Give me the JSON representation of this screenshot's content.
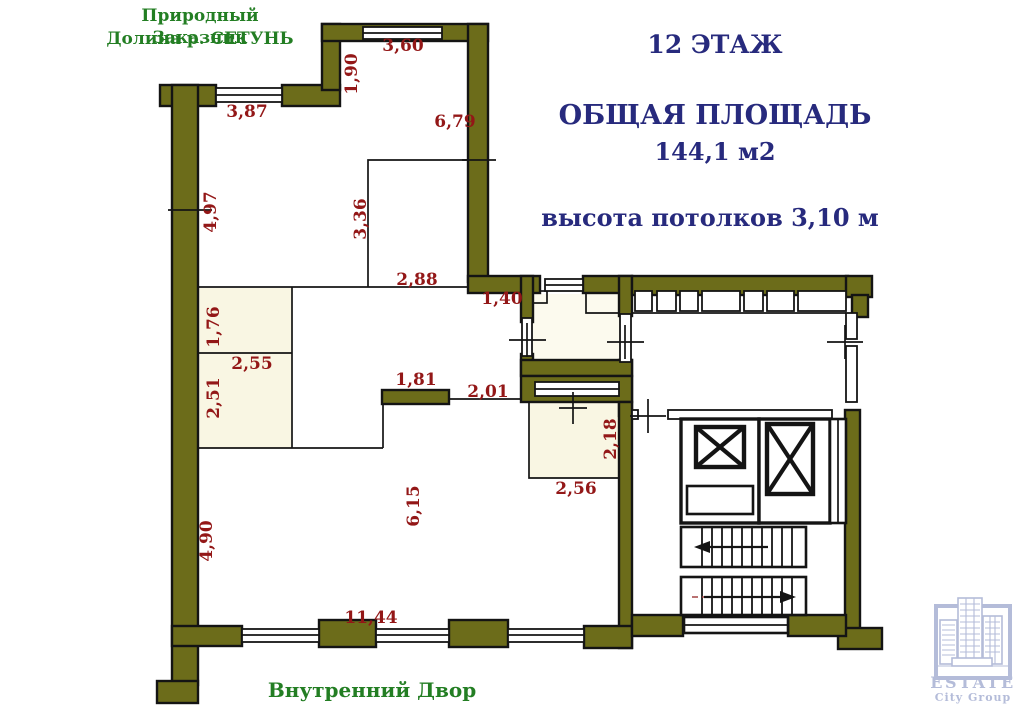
{
  "page": {
    "width": 1023,
    "height": 710,
    "background": "#ffffff"
  },
  "colors": {
    "wall": "#6c6c1a",
    "outline": "#141414",
    "cream": "#f9f6e3",
    "cream2": "#fcfaee",
    "red": "#931717",
    "green": "#237e23",
    "navy": "#272a7d",
    "logo": "#a8b1d3"
  },
  "header": {
    "nature_reserve_line1": "Природный Заказник",
    "nature_reserve_line2": "Долина р. СЕТУНЬ",
    "floor_title": "12 ЭТАЖ",
    "area_title": "ОБЩАЯ ПЛОЩАДЬ",
    "area_value": "144,1 м2",
    "ceiling_height": "высота потолков 3,10 м"
  },
  "footer": {
    "courtyard": "Внутренний Двор"
  },
  "logo": {
    "line1": "ESTATE",
    "line2": "City Group"
  },
  "dimensions": [
    {
      "text": "3,60",
      "x": 403,
      "y": 46
    },
    {
      "text": "1,90",
      "x": 352,
      "y": 74,
      "rot": true
    },
    {
      "text": "3,87",
      "x": 247,
      "y": 112
    },
    {
      "text": "6,79",
      "x": 455,
      "y": 122
    },
    {
      "text": "4,97",
      "x": 211,
      "y": 212,
      "rot": true
    },
    {
      "text": "3,36",
      "x": 361,
      "y": 219,
      "rot": true
    },
    {
      "text": "2,88",
      "x": 417,
      "y": 280
    },
    {
      "text": "1,40",
      "x": 502,
      "y": 299
    },
    {
      "text": "1,76",
      "x": 214,
      "y": 327,
      "rot": true
    },
    {
      "text": "2,55",
      "x": 252,
      "y": 364
    },
    {
      "text": "2,51",
      "x": 214,
      "y": 398,
      "rot": true
    },
    {
      "text": "1,81",
      "x": 416,
      "y": 380
    },
    {
      "text": "2,01",
      "x": 488,
      "y": 392
    },
    {
      "text": "2,18",
      "x": 611,
      "y": 439,
      "rot": true
    },
    {
      "text": "2,56",
      "x": 576,
      "y": 489
    },
    {
      "text": "6,15",
      "x": 414,
      "y": 506,
      "rot": true
    },
    {
      "text": "4,90",
      "x": 207,
      "y": 541,
      "rot": true
    },
    {
      "text": "11,44",
      "x": 371,
      "y": 618
    }
  ]
}
